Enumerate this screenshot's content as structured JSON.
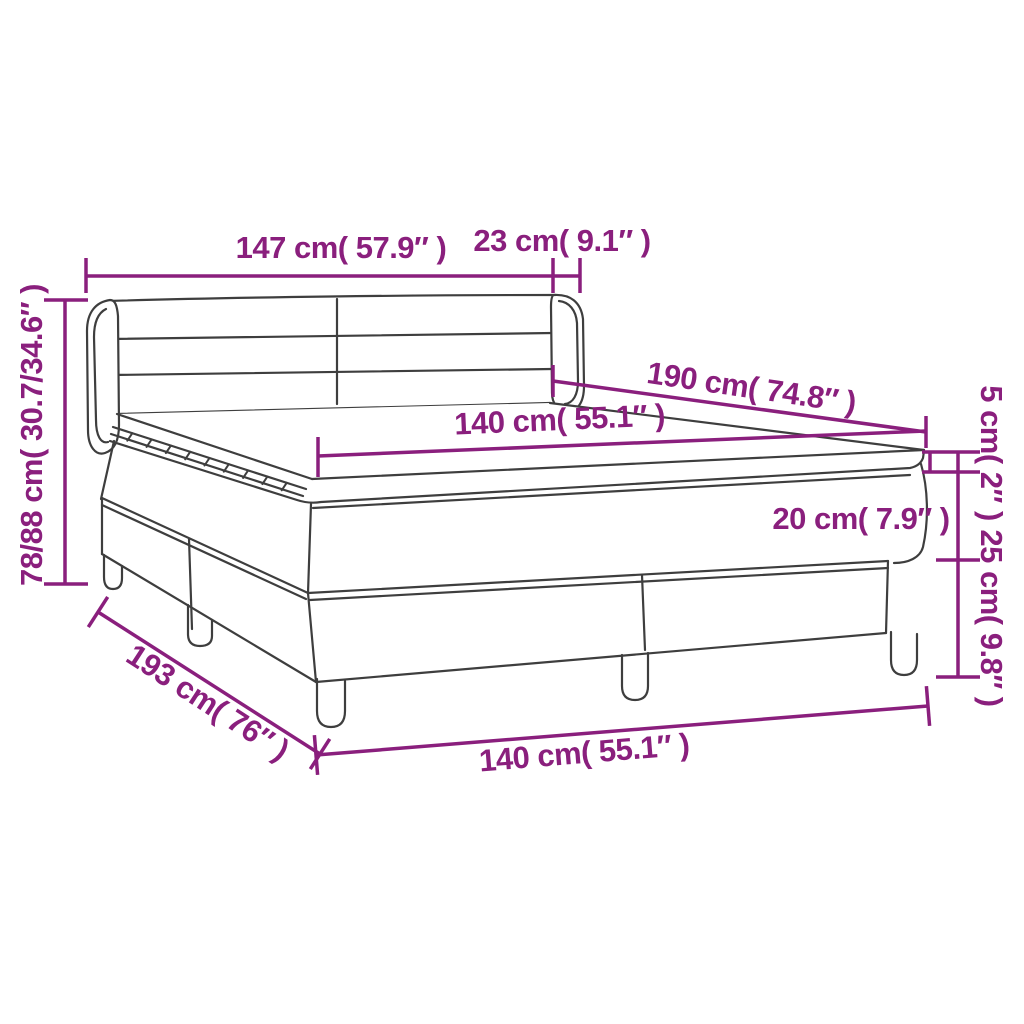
{
  "diagram": {
    "title": "box-spring-bed-dimension-diagram",
    "product": "Box spring bed with headboard, mattress and topper",
    "accent_color": "#8a1f7d",
    "line_color": "#3e3e3e",
    "background_color": "#ffffff",
    "dimensions": [
      {
        "id": "headboard-width",
        "label": "147 cm( 57.9″ )"
      },
      {
        "id": "headboard-depth",
        "label": "23 cm( 9.1″ )"
      },
      {
        "id": "bed-length",
        "label": "190 cm( 74.8″ )"
      },
      {
        "id": "mattress-width",
        "label": "140 cm( 55.1″ )"
      },
      {
        "id": "total-height",
        "label": "78/88 cm( 30.7/34.6″ )"
      },
      {
        "id": "topper-height",
        "label": "5 cm( 2″ )"
      },
      {
        "id": "mattress-height",
        "label": "20 cm( 7.9″ )"
      },
      {
        "id": "base-height",
        "label": "25 cm( 9.8″ )"
      },
      {
        "id": "base-length",
        "label": "193 cm( 76″ )"
      },
      {
        "id": "base-width",
        "label": "140 cm( 55.1″ )"
      }
    ]
  }
}
